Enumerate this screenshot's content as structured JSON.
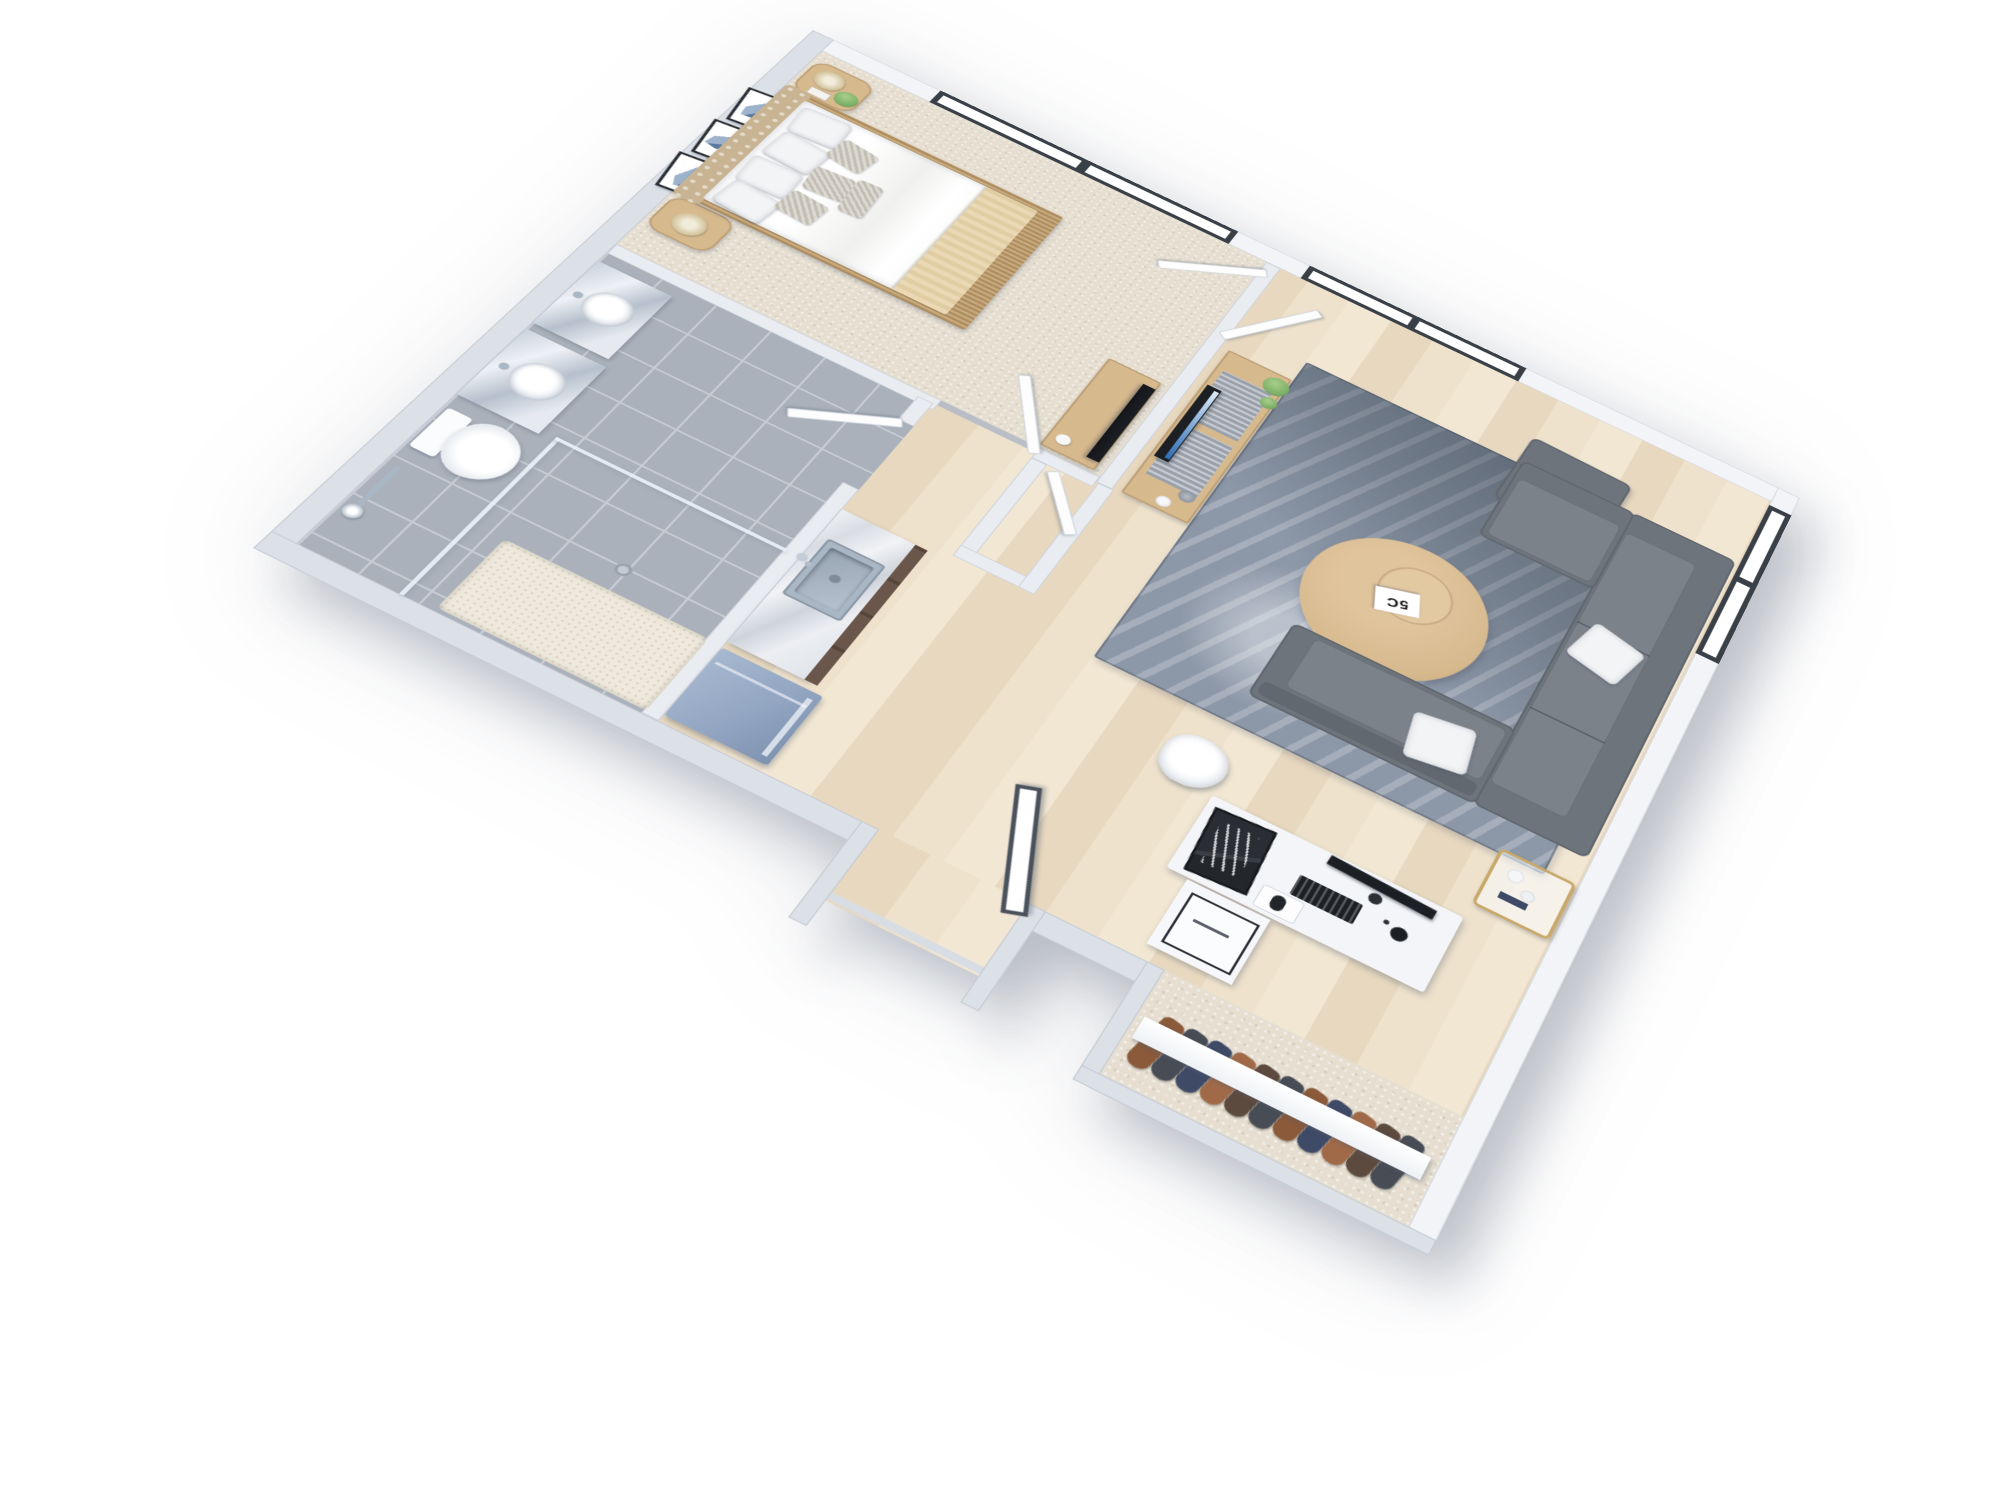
{
  "image_type": "3d-isometric-floor-plan-render",
  "apartment": {
    "description": "One-bedroom apartment 3D floor plan, white walls, viewed from above at an angle",
    "rooms": [
      {
        "id": "bedroom",
        "label": "Bedroom",
        "floor_finish": "beige carpet",
        "furniture": [
          "double bed with white duvet",
          "tufted beige headboard",
          "cream throw blanket",
          "white and silver patterned pillows",
          "rattan footboard",
          "round wood nightstand with lamp and plant",
          "round wood nightstand with lamp",
          "three framed blue abstract artworks",
          "black tv on low cabinet",
          "double-pane window"
        ]
      },
      {
        "id": "bathroom",
        "label": "Bathroom",
        "floor_finish": "gray tile",
        "furniture": [
          "marble-top vanity with round basin",
          "second marble-top vanity with round basin",
          "toilet",
          "walk-in glass shower with cream tray",
          "wall shower set",
          "floor drain"
        ]
      },
      {
        "id": "walk_in_closet",
        "label": "Walk-in closet",
        "floor_finish": "beige carpet",
        "furniture": [
          "white door"
        ]
      },
      {
        "id": "kitchen",
        "label": "Kitchenette",
        "floor_finish": "light wood plank",
        "furniture": [
          "marble counter with dark cabinets",
          "stainless steel inset sink with faucet",
          "slate-blue appliance"
        ]
      },
      {
        "id": "living_room",
        "label": "Living room",
        "floor_finish": "light wood plank",
        "furniture": [
          "gray sectional sofa with two white pillows",
          "gray ottoman",
          "blue-gray cityscape area rug",
          "round oak coffee table",
          "white magazine",
          "oak tv console with slatted doors",
          "flat tv with blue screen",
          "two green plants",
          "gray vase and white bowl",
          "gold-frame side table",
          "white desk",
          "monitor on arm",
          "black keyboard and mouse",
          "microphone",
          "white shell desk chair",
          "white drawer unit",
          "black poster print",
          "double-pane window",
          "side window"
        ]
      },
      {
        "id": "entry",
        "label": "Entry",
        "floor_finish": "light wood plank",
        "furniture": [
          "dark-framed glazed entry door"
        ]
      },
      {
        "id": "closet_nook",
        "label": "Open closet",
        "floor_finish": "beige carpet",
        "furniture": [
          "white shelf",
          "clothes rail",
          "hanging clothes in brown, navy and charcoal"
        ]
      }
    ],
    "windows": [
      {
        "id": "bedroom-window",
        "wall": "upper-right",
        "panes": 2,
        "frame": "dark charcoal"
      },
      {
        "id": "living-window",
        "wall": "upper-right",
        "panes": 2,
        "frame": "dark charcoal"
      },
      {
        "id": "side-window",
        "wall": "right",
        "panes": 2,
        "frame": "dark charcoal"
      }
    ],
    "doors": [
      {
        "id": "bedroom-double-door",
        "type": "white hinged pair, open"
      },
      {
        "id": "bedroom-hall-door",
        "type": "white hinged, open"
      },
      {
        "id": "walk-in-closet-door",
        "type": "white hinged, open"
      },
      {
        "id": "bathroom-door",
        "type": "white hinged, open"
      },
      {
        "id": "entry-door",
        "type": "dark framed glazed, open"
      }
    ]
  },
  "decor": {
    "coffee_table_book_text": "5C"
  },
  "palette": {
    "wall_face": "#e9ecf1",
    "wall_top": "#f2f4f7",
    "wall_outer": "#dce1e8",
    "carpet": "#e6dfd1",
    "tile": "#aab1bb",
    "tile_grout": "#c7ccd4",
    "wood": "#eee2cc",
    "wood_stripe": "#e7d8bf",
    "rug": "#8c97a7",
    "rug_dark": "#4e5a68",
    "sofa": "#6e747c",
    "sofa_light": "#7b828a",
    "cushion_white": "#f3f4f6",
    "wood_furniture": "#d7b98e",
    "wood_bed": "#c8a97c",
    "headboard": "#c8b492",
    "tv_black": "#1c1f24",
    "tv_screen_top": "#dcebf8",
    "tv_screen_bottom": "#2e6cb4",
    "frame_dark": "#3a4047",
    "glass": "#ffffff",
    "door_white": "#fdfdfe",
    "entry_frame": "#4a515b",
    "marble_vein": "#c6ccd6",
    "cabinet": "#6a564a",
    "steel": "#a9b6c4",
    "appliance": "#93a6c2",
    "porcelain": "#fafbfc",
    "vanity_marble": "#b6c0cd",
    "throw": "#ead9b4",
    "lamp": "#d8cba6",
    "plant": "#7fb069",
    "clothes_brown": "#8a5a3a",
    "clothes_tan": "#a06a48",
    "clothes_navy": "#3f4a66",
    "clothes_charcoal": "#474c55",
    "clothes_umber": "#5d4a3e"
  }
}
